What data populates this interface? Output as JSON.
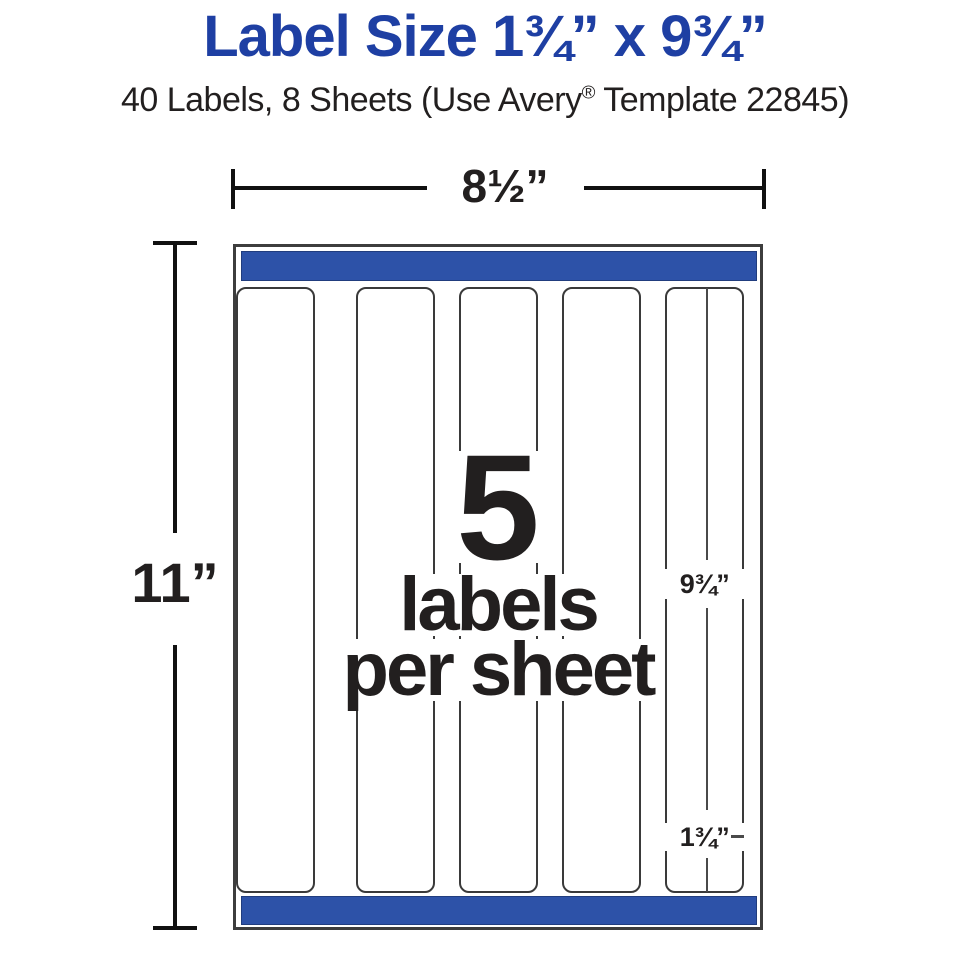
{
  "title": {
    "text": "Label Size 1¾” x 9¾”"
  },
  "subtitle": {
    "prefix": "40 Labels, 8 Sheets (Use Avery",
    "registered_mark": "®",
    "suffix": " Template 22845)"
  },
  "dimensions": {
    "sheet_width": "8½”",
    "sheet_height": "11”",
    "label_height": "9¾”",
    "label_width": "1¾”"
  },
  "sheet": {
    "labels_count": "5",
    "labels_word": "labels",
    "per_sheet_word": "per sheet",
    "columns": 5
  },
  "colors": {
    "title_blue": "#1e3fa3",
    "bar_blue": "#2d52a8",
    "text_black": "#221f1f"
  }
}
